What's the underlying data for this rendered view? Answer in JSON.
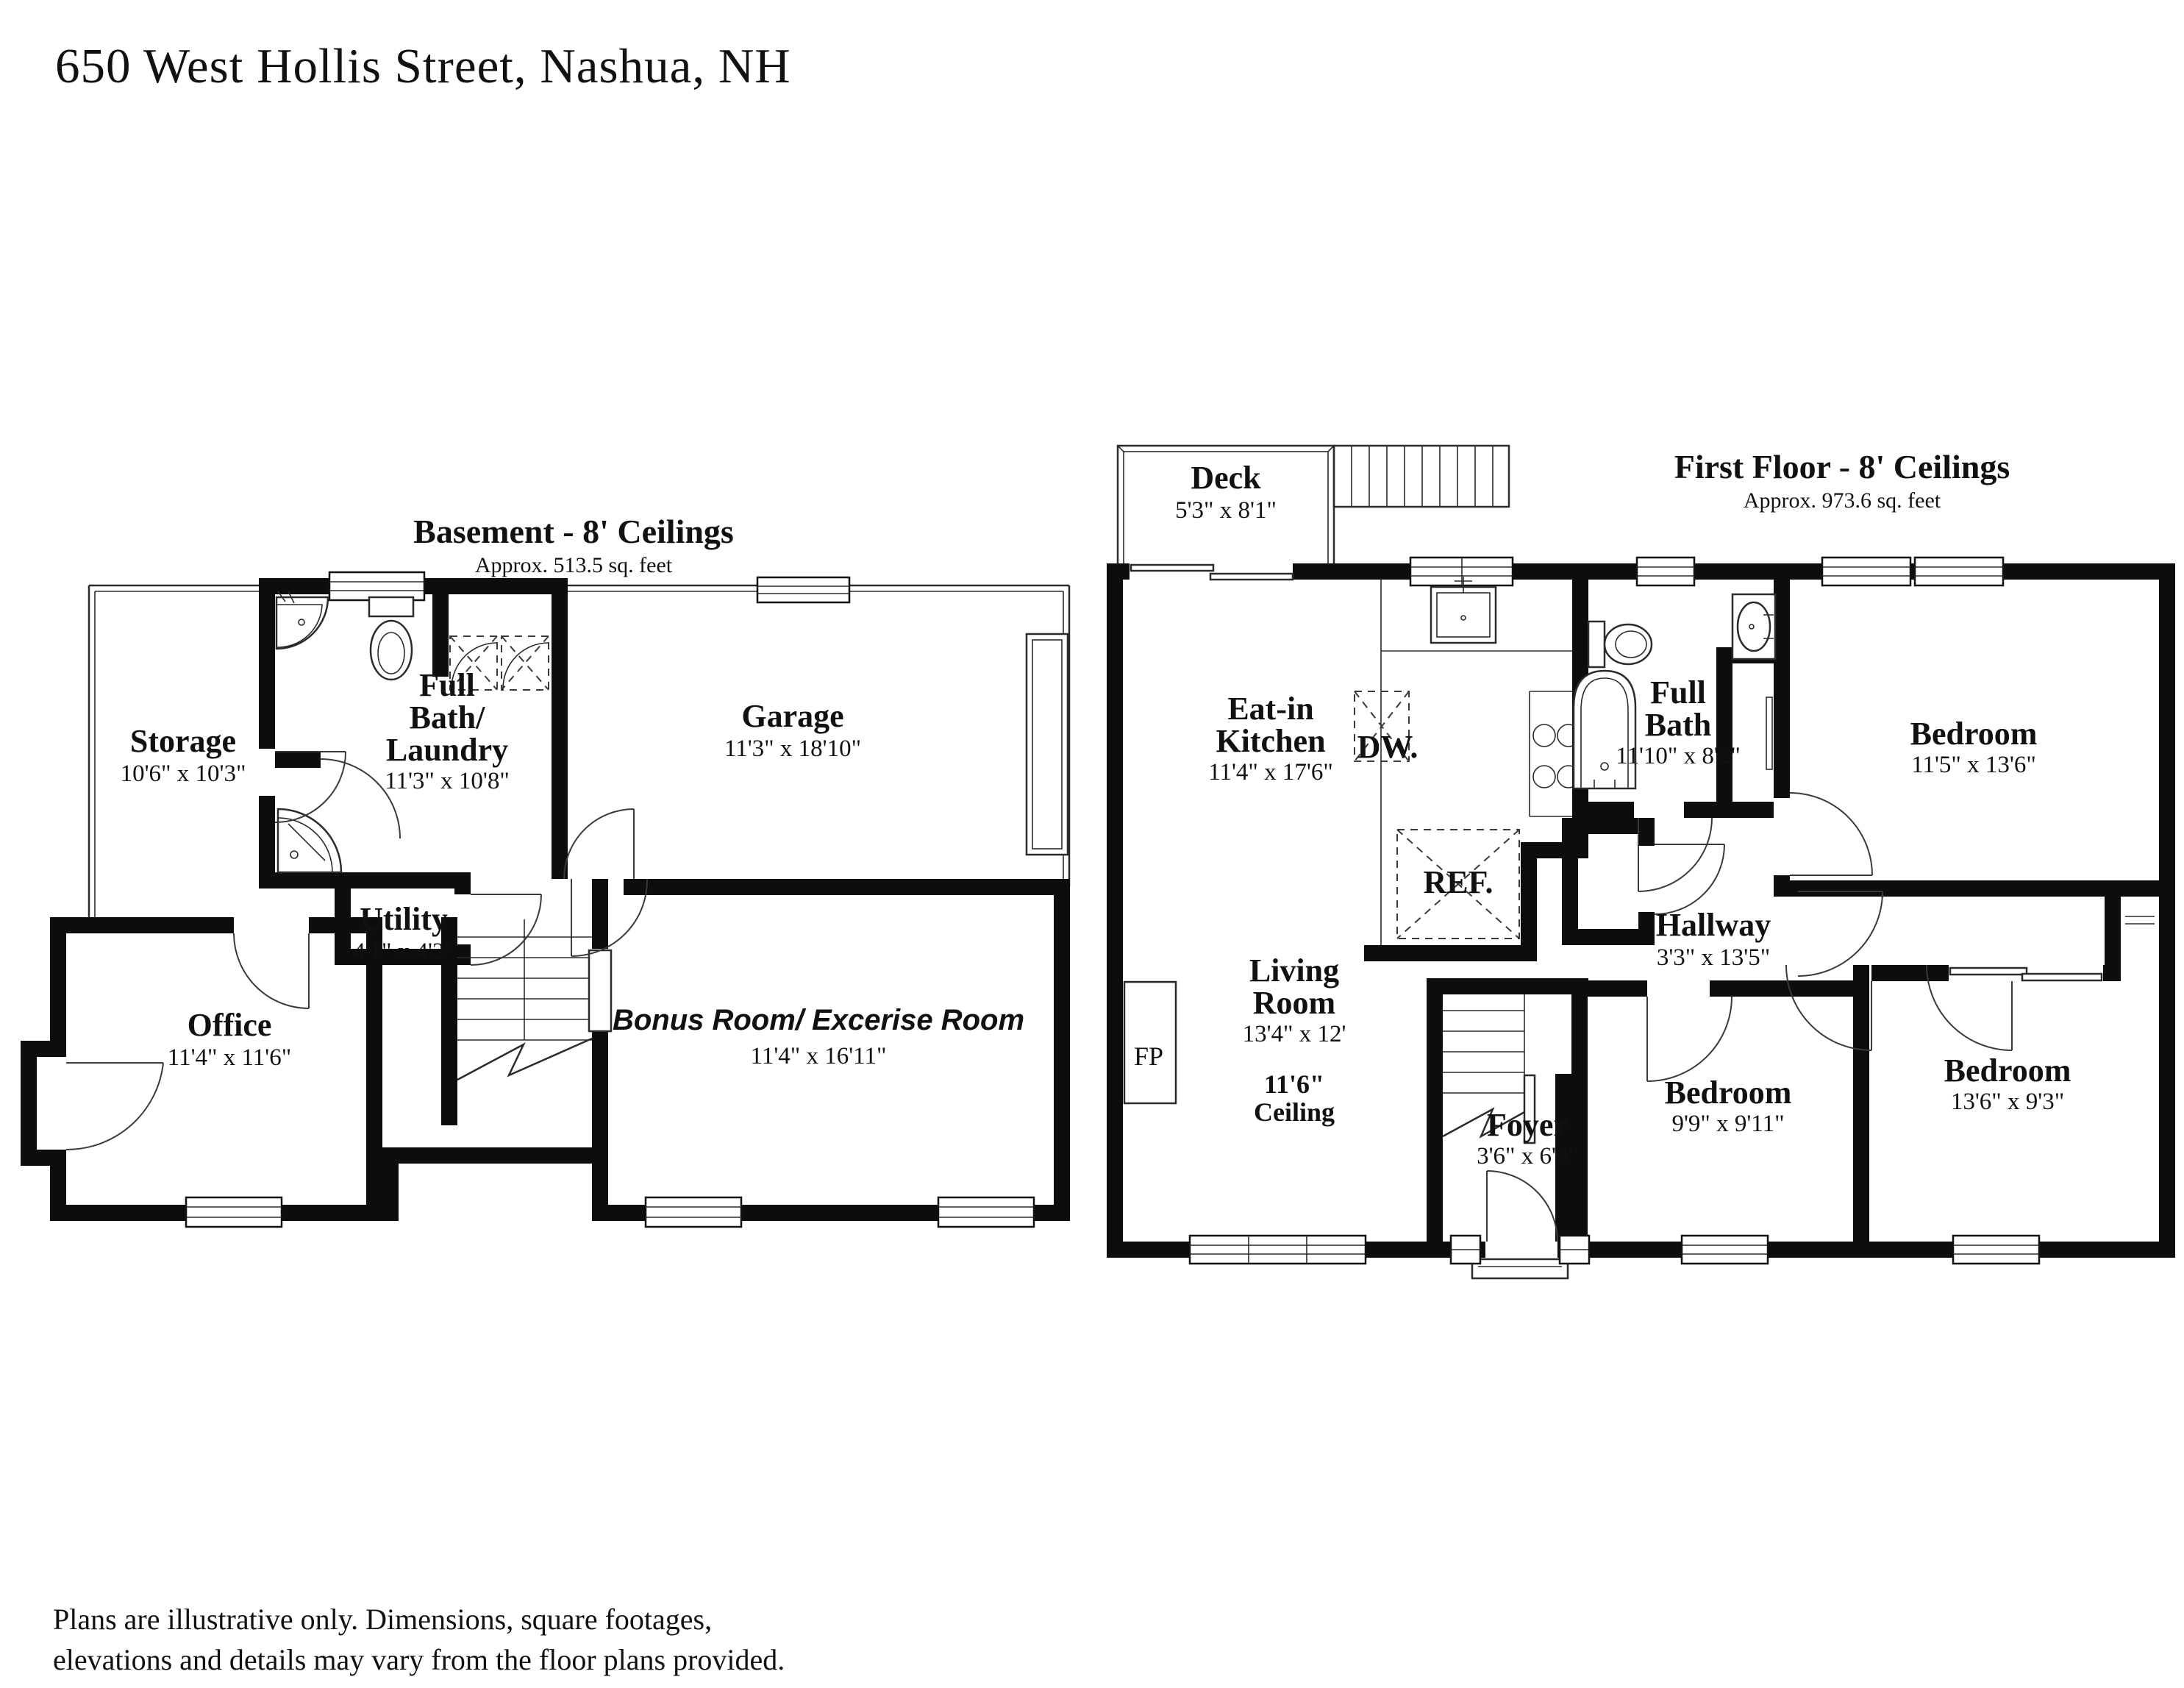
{
  "page": {
    "title": "650 West Hollis Street, Nashua, NH",
    "disclaimer_line1": "Plans are illustrative only. Dimensions, square footages,",
    "disclaimer_line2": "elevations and details may vary from the floor plans provided."
  },
  "basement": {
    "title": "Basement - 8' Ceilings",
    "subtitle": "Approx. 513.5 sq. feet",
    "rooms": {
      "storage": {
        "name": "Storage",
        "dims": "10'6\" x 10'3\""
      },
      "full_bath": {
        "line1": "Full",
        "line2": "Bath/",
        "line3": "Laundry",
        "dims": "11'3\" x 10'8\""
      },
      "utility": {
        "name": "Utility",
        "dims": "4'1\" x 4'2\""
      },
      "garage": {
        "name": "Garage",
        "dims": "11'3\" x 18'10\""
      },
      "office": {
        "name": "Office",
        "dims": "11'4\" x 11'6\""
      },
      "bonus": {
        "name": "Bonus Room/ Excerise Room",
        "dims": "11'4\" x 16'11\""
      }
    }
  },
  "first_floor": {
    "title": "First Floor - 8' Ceilings",
    "subtitle": "Approx. 973.6 sq. feet",
    "rooms": {
      "deck": {
        "name": "Deck",
        "dims": "5'3\" x 8'1\""
      },
      "kitchen": {
        "line1": "Eat-in",
        "line2": "Kitchen",
        "dims": "11'4\" x 17'6\""
      },
      "full_bath": {
        "line1": "Full",
        "line2": "Bath",
        "dims": "11'10\" x 8'2\""
      },
      "bedroom1": {
        "name": "Bedroom",
        "dims": "11'5\" x 13'6\""
      },
      "hallway": {
        "name": "Hallway",
        "dims": "3'3\" x 13'5\""
      },
      "living": {
        "line1": "Living",
        "line2": "Room",
        "dims": "13'4\" x 12'",
        "ceiling1": "11'6\"",
        "ceiling2": "Ceiling"
      },
      "foyer": {
        "name": "Foyer",
        "dims": "3'6\" x 6'9\""
      },
      "bedroom2": {
        "name": "Bedroom",
        "dims": "9'9\" x 9'11\""
      },
      "bedroom3": {
        "name": "Bedroom",
        "dims": "13'6\" x 9'3\""
      }
    },
    "appliances": {
      "dishwasher": "DW.",
      "refrigerator": "REF.",
      "fireplace": "FP"
    }
  }
}
